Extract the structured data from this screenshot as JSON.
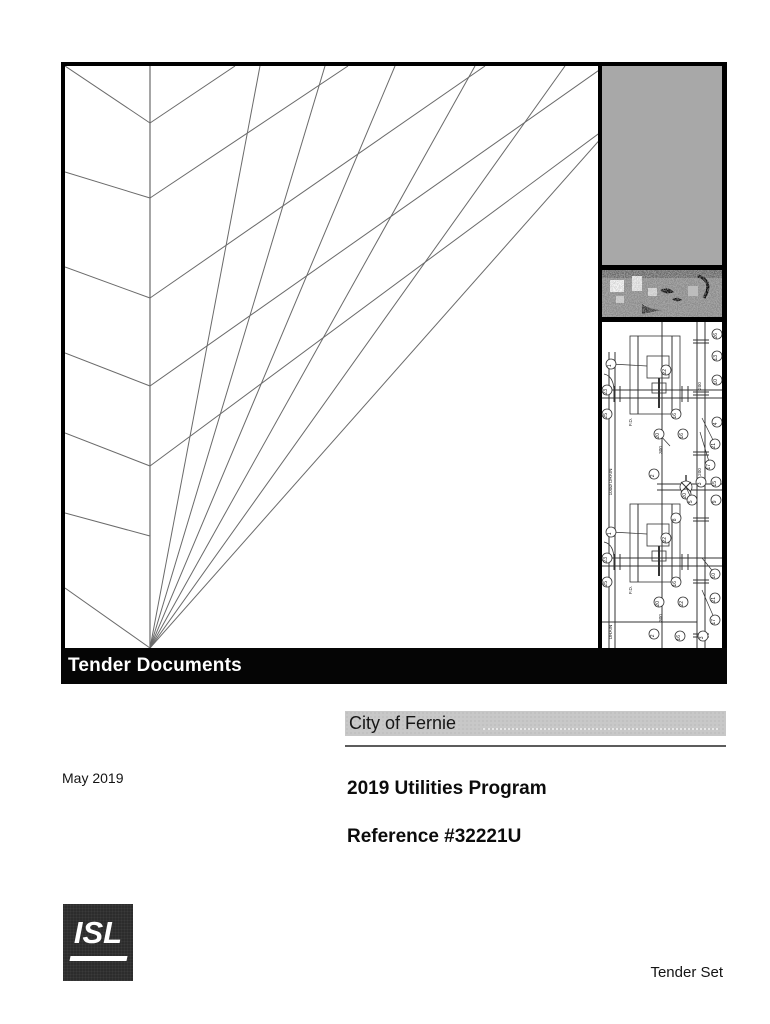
{
  "cover": {
    "banner": "Tender Documents",
    "client": "City of Fernie",
    "date": "May 2019",
    "title": "2019 Utilities Program",
    "reference": "Reference #32221U",
    "footer": "Tender Set",
    "logo_text": "ISL"
  },
  "colors": {
    "banner_bg": "#050505",
    "client_bar_bg": "#c8c8c8",
    "gray_box": "#a8a8a8",
    "logo_bg": "#2c2c2c",
    "art_stroke": "#6a6a6a",
    "drawing_stroke": "#333333"
  },
  "cover_art": {
    "vertical": {
      "x": 85,
      "y1": 0,
      "y2": 582
    },
    "chevrons": [
      [
        0,
        0,
        85,
        57
      ],
      [
        0,
        106,
        85,
        132
      ],
      [
        0,
        201,
        85,
        232
      ],
      [
        0,
        287,
        85,
        320
      ],
      [
        0,
        367,
        85,
        400
      ],
      [
        0,
        447,
        85,
        470
      ],
      [
        0,
        522,
        85,
        582
      ]
    ],
    "up_legs": [
      [
        85,
        57,
        170,
        0
      ],
      [
        85,
        132,
        283,
        0
      ],
      [
        85,
        232,
        420,
        0
      ],
      [
        85,
        320,
        540,
        0
      ],
      [
        85,
        400,
        625,
        0
      ]
    ],
    "sweeps": [
      [
        195,
        0,
        85,
        582
      ],
      [
        260,
        0,
        85,
        582
      ],
      [
        330,
        0,
        85,
        582
      ],
      [
        410,
        0,
        85,
        582
      ],
      [
        500,
        0,
        85,
        582
      ],
      [
        600,
        0,
        85,
        582
      ]
    ]
  },
  "drawing": {
    "station_offsets": [
      14,
      182
    ],
    "callouts": [
      {
        "x": 9,
        "y": 42,
        "l": "1",
        "lx": 45,
        "ly": 44
      },
      {
        "x": 5,
        "y": 68,
        "l": "23"
      },
      {
        "x": 5,
        "y": 92,
        "l": "25"
      },
      {
        "x": 64,
        "y": 48,
        "l": "22"
      },
      {
        "x": 115,
        "y": 12,
        "l": "26"
      },
      {
        "x": 115,
        "y": 34,
        "l": "13"
      },
      {
        "x": 115,
        "y": 58,
        "l": "10"
      },
      {
        "x": 74,
        "y": 92,
        "l": "16"
      },
      {
        "x": 115,
        "y": 100,
        "l": "4"
      },
      {
        "x": 57,
        "y": 112,
        "l": "20",
        "lx": 68,
        "ly": 124
      },
      {
        "x": 81,
        "y": 112,
        "l": "16"
      },
      {
        "x": 113,
        "y": 122,
        "l": "21",
        "lx": 100,
        "ly": 96
      },
      {
        "x": 108,
        "y": 143,
        "l": "17",
        "lx": 98,
        "ly": 110
      },
      {
        "x": 99,
        "y": 160,
        "l": "3"
      },
      {
        "x": 114,
        "y": 160,
        "l": "15"
      },
      {
        "x": 52,
        "y": 152,
        "l": "2"
      },
      {
        "x": 84,
        "y": 172,
        "l": "20"
      },
      {
        "x": 9,
        "y": 210,
        "l": "1",
        "lx": 45,
        "ly": 212
      },
      {
        "x": 5,
        "y": 236,
        "l": "23"
      },
      {
        "x": 5,
        "y": 260,
        "l": "25"
      },
      {
        "x": 64,
        "y": 216,
        "l": "22"
      },
      {
        "x": 90,
        "y": 178,
        "l": "5",
        "lx": 84,
        "ly": 165
      },
      {
        "x": 114,
        "y": 178,
        "l": "9"
      },
      {
        "x": 74,
        "y": 196,
        "l": "8"
      },
      {
        "x": 74,
        "y": 260,
        "l": "16"
      },
      {
        "x": 57,
        "y": 280,
        "l": "20"
      },
      {
        "x": 81,
        "y": 280,
        "l": "22"
      },
      {
        "x": 52,
        "y": 312,
        "l": "2"
      },
      {
        "x": 78,
        "y": 314,
        "l": "16"
      },
      {
        "x": 101,
        "y": 314,
        "l": "3"
      },
      {
        "x": 113,
        "y": 298,
        "l": "17",
        "lx": 100,
        "ly": 268
      },
      {
        "x": 113,
        "y": 276,
        "l": "21"
      },
      {
        "x": 113,
        "y": 252,
        "l": "10",
        "lx": 100,
        "ly": 236
      }
    ],
    "labels": [
      {
        "x": 60,
        "y": 128,
        "t": "300"
      },
      {
        "x": 99,
        "y": 64,
        "t": "200"
      },
      {
        "x": 99,
        "y": 150,
        "t": "200"
      },
      {
        "x": 30,
        "y": 100,
        "t": "F.D."
      },
      {
        "x": 30,
        "y": 268,
        "t": "F.D."
      },
      {
        "x": 10,
        "y": 160,
        "t": "100Ø DRAIN"
      },
      {
        "x": 10,
        "y": 310,
        "t": "DRAIN"
      },
      {
        "x": 60,
        "y": 296,
        "t": "300"
      }
    ]
  }
}
